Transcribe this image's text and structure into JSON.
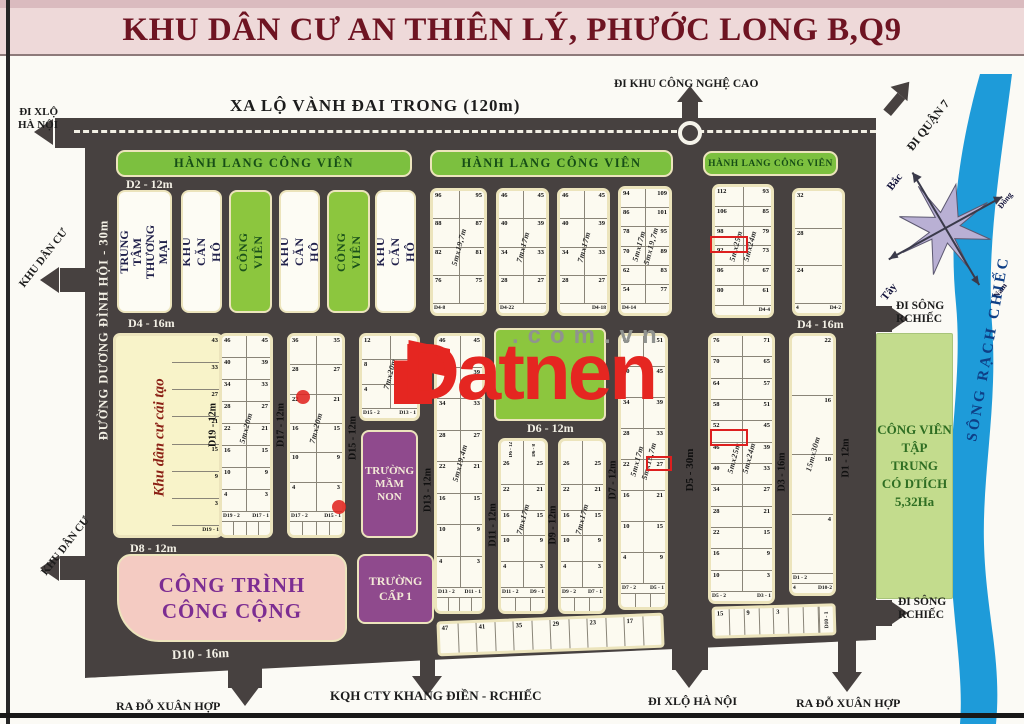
{
  "header": {
    "title": "KHU DÂN CƯ AN THIÊN LÝ, PHƯỚC LONG B,Q9"
  },
  "watermark": {
    "brand": "Datnen",
    "domain": ".com.vn"
  },
  "roads": {
    "ring_road": "XA LỘ VÀNH ĐAI TRONG (120m)",
    "duong_dinh_hoi": "ĐƯỜNG DƯƠNG ĐÌNH HỘI - 30m",
    "d2": "D2 - 12m",
    "d4": "D4 - 16m",
    "d6": "D6 - 12m",
    "d8": "D8 - 12m",
    "d10": "D10 - 16m",
    "d19": "D19 - 12m",
    "d17": "D17 - 12m",
    "d15": "D15 - 12m",
    "d13": "D13 - 12m",
    "d11": "D11 - 12m",
    "d9": "D9 - 12m",
    "d7": "D7 - 12m",
    "d5": "D5 - 30m",
    "d3": "D3 - 16m",
    "d1": "D1 - 12m"
  },
  "exits": {
    "hi_tech_park": "ĐI KHU CÔNG NGHỆ CAO",
    "hanoi_highway_left": "ĐI XLỘ\nHÀ NỘI",
    "district7": "ĐI QUẬN 7",
    "residential_upper": "KHU DÂN CƯ",
    "residential_lower": "KHU DÂN CƯ",
    "rach_chiec_upper": "ĐI SÔNG\nRCHIẾC",
    "rach_chiec_lower": "ĐI SÔNG\nRCHIẾC",
    "do_xuan_hop_left": "RA ĐỖ XUÂN HỢP",
    "khang_dien": "KQH CTY KHANG ĐIỀN - RCHIẾC",
    "hanoi_highway_bottom": "ĐI XLỘ HÀ NỘI",
    "do_xuan_hop_right": "RA ĐỖ XUÂN HỢP"
  },
  "zones": {
    "corridor": "HÀNH LANG CÔNG VIÊN",
    "commercial": "TRUNG TÂM\nTHƯƠNG MẠI",
    "apartment": "KHU CĂN HỘ",
    "park_small": "CÔNG VIÊN",
    "renovation": "Khu dân cư cải tạo",
    "kindergarten": "TRƯỜNG\nMẦM\nNON",
    "public_works": "CÔNG TRÌNH\nCÔNG CỘNG",
    "primary_school": "TRƯỜNG\nCẤP 1",
    "central_park": "CÔNG VIÊN\nTẬP TRUNG\nCÓ DTÍCH\n5,32Ha",
    "river": "SÔNG RẠCH CHIẾC"
  },
  "compass": {
    "north": "Bắc",
    "south": "Nam",
    "east": "Đông",
    "west": "Tây"
  },
  "plot_blocks": [
    {
      "id": "tb1",
      "split": true,
      "dims": [
        "5mx19,7m"
      ],
      "rows": [
        [
          "96",
          "95"
        ],
        [
          "88",
          "87"
        ],
        [
          "82",
          "81"
        ],
        [
          "76",
          "75"
        ]
      ],
      "footer": [
        "D4-8",
        ""
      ]
    },
    {
      "id": "tb2",
      "split": true,
      "dims": [
        "7mx17m"
      ],
      "rows": [
        [
          "46",
          "45"
        ],
        [
          "40",
          "39"
        ],
        [
          "34",
          "33"
        ],
        [
          "28",
          "27"
        ]
      ],
      "footer": [
        "D4-22",
        ""
      ]
    },
    {
      "id": "tb3",
      "split": true,
      "dims": [
        "7mx17m"
      ],
      "rows": [
        [
          "46",
          "45"
        ],
        [
          "40",
          "39"
        ],
        [
          "34",
          "33"
        ],
        [
          "28",
          "27"
        ]
      ],
      "footer": [
        "",
        "D4-18"
      ]
    },
    {
      "id": "tb4",
      "split": true,
      "dims": [
        "5mx17m",
        "5mx19,7m"
      ],
      "rows": [
        [
          "94",
          "109"
        ],
        [
          "86",
          "101"
        ],
        [
          "78",
          "95"
        ],
        [
          "70",
          "89"
        ],
        [
          "62",
          "83"
        ],
        [
          "54",
          "77"
        ]
      ],
      "footer": [
        "D4-14",
        ""
      ]
    },
    {
      "id": "tb5",
      "split": true,
      "dims": [
        "5mx25m",
        "5mx24m"
      ],
      "rows": [
        [
          "112",
          "93"
        ],
        [
          "106",
          "85"
        ],
        [
          "98",
          "79"
        ],
        [
          "92",
          "73"
        ],
        [
          "86",
          "67"
        ],
        [
          "80",
          "61"
        ]
      ],
      "footer": [
        "",
        "D4-4"
      ]
    },
    {
      "id": "tb6",
      "split": false,
      "rows": [
        [
          "32",
          ""
        ],
        [
          "28",
          ""
        ],
        [
          "24",
          ""
        ]
      ],
      "footer": [
        "4",
        "D4-2"
      ]
    },
    {
      "id": "caitao",
      "cls": "cream",
      "split": false,
      "rows": [
        [
          "",
          "43"
        ],
        [
          "",
          "33"
        ],
        [
          "",
          "27"
        ],
        [
          "",
          "21"
        ],
        [
          "",
          "15"
        ],
        [
          "",
          "9"
        ],
        [
          "",
          "3"
        ]
      ],
      "footer": [
        "",
        "D19 - 1"
      ]
    },
    {
      "id": "mb1",
      "split": true,
      "dims": [
        "5mx20m"
      ],
      "rows": [
        [
          "46",
          "45"
        ],
        [
          "40",
          "39"
        ],
        [
          "34",
          "33"
        ],
        [
          "28",
          "27"
        ],
        [
          "22",
          "21"
        ],
        [
          "16",
          "15"
        ],
        [
          "10",
          "9"
        ],
        [
          "4",
          "3"
        ]
      ],
      "footer": [
        "D19 - 2",
        "D17 - 1"
      ],
      "sub": 4
    },
    {
      "id": "mb2",
      "split": true,
      "dims": [
        "7mx20m"
      ],
      "rows": [
        [
          "36",
          "35"
        ],
        [
          "28",
          "27"
        ],
        [
          "22",
          "21"
        ],
        [
          "16",
          "15"
        ],
        [
          "10",
          "9"
        ],
        [
          "4",
          "3"
        ]
      ],
      "footer": [
        "D17 - 2",
        "D15 - 1"
      ],
      "sub": 4
    },
    {
      "id": "mb3",
      "split": true,
      "dims": [
        "7mx20m"
      ],
      "rows": [
        [
          "12",
          ""
        ],
        [
          "8",
          ""
        ],
        [
          "4",
          ""
        ]
      ],
      "footer": [
        "D15 - 2",
        "D13 - 1"
      ]
    },
    {
      "id": "mb4",
      "split": true,
      "dims": [
        "5mx19,4m"
      ],
      "rows": [
        [
          "46",
          "45"
        ],
        [
          "40",
          "39"
        ],
        [
          "34",
          "33"
        ],
        [
          "28",
          "27"
        ],
        [
          "22",
          "21"
        ],
        [
          "16",
          "15"
        ],
        [
          "10",
          "9"
        ],
        [
          "4",
          "3"
        ]
      ],
      "footer": [
        "D13 - 2",
        "D11 - 1"
      ],
      "sub": 4
    },
    {
      "id": "mb5",
      "split": true,
      "dims": [
        "7mx17m"
      ],
      "tops": [
        "D6 - 12",
        "D6 - 8"
      ],
      "rows": [
        [
          "26",
          "25"
        ],
        [
          "22",
          "21"
        ],
        [
          "16",
          "15"
        ],
        [
          "10",
          "9"
        ],
        [
          "4",
          "3"
        ]
      ],
      "footer": [
        "D11 - 2",
        "D9 - 1"
      ],
      "sub": 3
    },
    {
      "id": "mb6",
      "split": true,
      "dims": [
        "7mx17m"
      ],
      "tops": [
        "",
        ""
      ],
      "rows": [
        [
          "26",
          "25"
        ],
        [
          "22",
          "21"
        ],
        [
          "16",
          "15"
        ],
        [
          "10",
          "9"
        ],
        [
          "4",
          "3"
        ]
      ],
      "footer": [
        "D9 - 2",
        "D7 - 1"
      ],
      "sub": 3
    },
    {
      "id": "mb7",
      "split": true,
      "dims": [
        "5mx17m",
        "5mx19,7m"
      ],
      "rows": [
        [
          "46",
          "51"
        ],
        [
          "40",
          "45"
        ],
        [
          "34",
          "39"
        ],
        [
          "28",
          "33"
        ],
        [
          "22",
          "27"
        ],
        [
          "16",
          "21"
        ],
        [
          "10",
          "15"
        ],
        [
          "4",
          "9"
        ]
      ],
      "footer": [
        "D7 - 2",
        "D5 - 1"
      ],
      "sub": 3
    },
    {
      "id": "mb8",
      "split": true,
      "dims": [
        "5mx25m",
        "5mx24m"
      ],
      "rows": [
        [
          "76",
          "71"
        ],
        [
          "70",
          "65"
        ],
        [
          "64",
          "57"
        ],
        [
          "58",
          "51"
        ],
        [
          "52",
          "45"
        ],
        [
          "46",
          "39"
        ],
        [
          "40",
          "33"
        ],
        [
          "34",
          "27"
        ],
        [
          "28",
          "21"
        ],
        [
          "22",
          "15"
        ],
        [
          "16",
          "9"
        ],
        [
          "10",
          "3"
        ]
      ],
      "footer": [
        "D5 - 2",
        "D3 - 1"
      ]
    },
    {
      "id": "mb9",
      "split": false,
      "dims": [
        "15mx30m"
      ],
      "rows": [
        [
          "",
          "22"
        ],
        [
          "",
          "16"
        ],
        [
          "",
          "10"
        ],
        [
          "",
          "4"
        ]
      ],
      "footer": [
        "D1 - 2",
        ""
      ],
      "footer2": [
        "4",
        "D10-2"
      ]
    },
    {
      "id": "strip1",
      "horizontal": true,
      "cells": 12,
      "nums": [
        "47",
        "41",
        "35",
        "29",
        "23",
        "17"
      ]
    },
    {
      "id": "strip2",
      "horizontal": true,
      "cells": 7,
      "nums": [
        "15",
        "9",
        "3"
      ],
      "end_label": "D10 - 1"
    }
  ]
}
